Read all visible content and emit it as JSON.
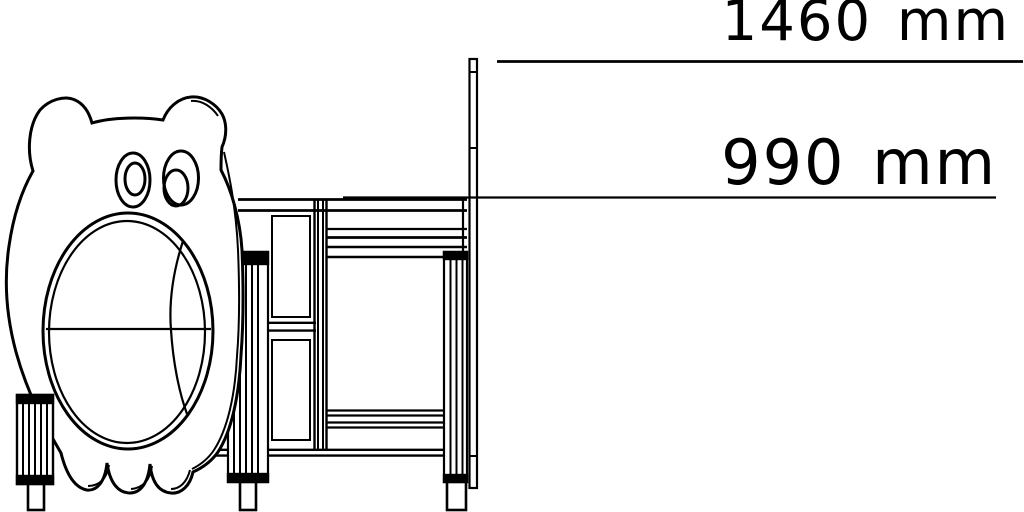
{
  "page": {
    "background": "#ffffff",
    "line_color": "#000000"
  },
  "drawing": {
    "dimensions": [
      {
        "label": "1460 mm",
        "value": 1460,
        "unit": "mm"
      },
      {
        "label": "990 mm",
        "value": 990,
        "unit": "mm"
      }
    ]
  }
}
